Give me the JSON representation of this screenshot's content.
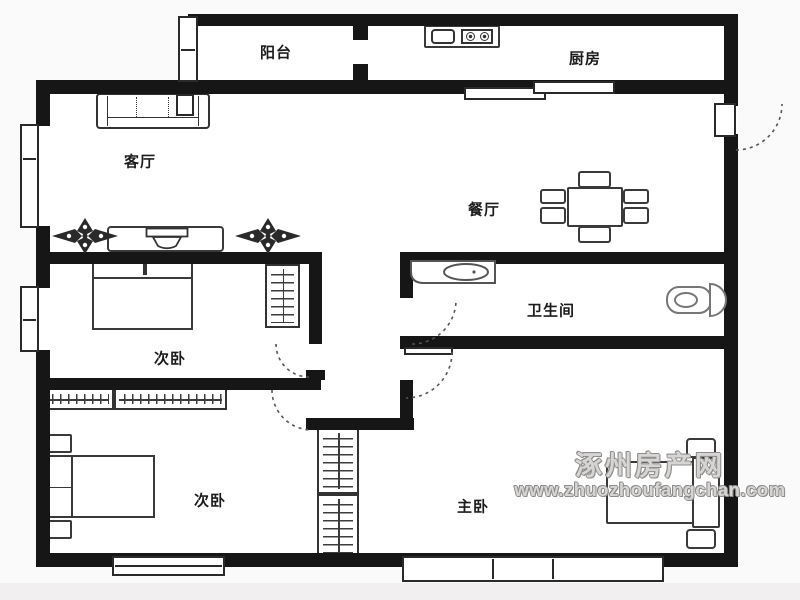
{
  "meta": {
    "wall_color": "#161616",
    "background": "#fbfafa",
    "watermark_color": "#8f8c8c"
  },
  "rooms": [
    {
      "id": "balcony",
      "label": "阳台"
    },
    {
      "id": "kitchen",
      "label": "厨房"
    },
    {
      "id": "living-room",
      "label": "客厅"
    },
    {
      "id": "dining-room",
      "label": "餐厅"
    },
    {
      "id": "bedroom-second-upper",
      "label": "次卧"
    },
    {
      "id": "bathroom",
      "label": "卫生间"
    },
    {
      "id": "bedroom-second-lower",
      "label": "次卧"
    },
    {
      "id": "master-bedroom",
      "label": "主卧"
    }
  ],
  "watermark": {
    "site_name": "涿州房产网",
    "url": "www.zhuozhoufangchan.com"
  }
}
